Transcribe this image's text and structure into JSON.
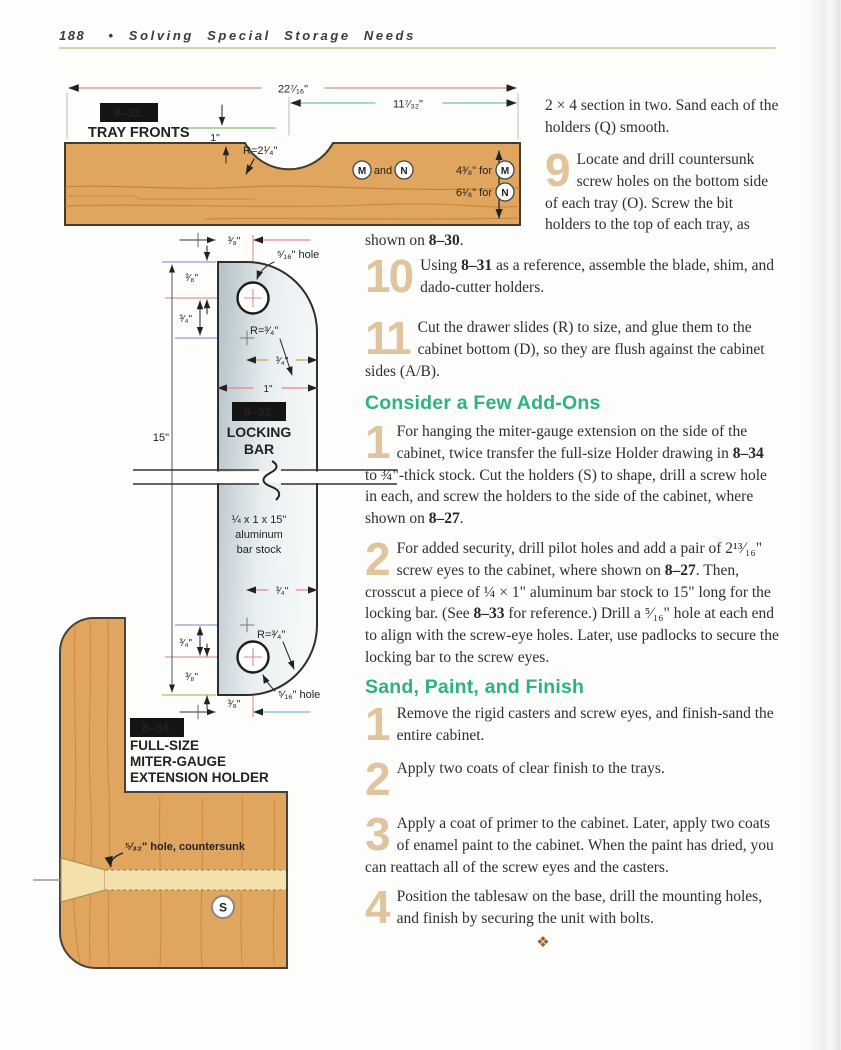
{
  "page": {
    "number": "188",
    "separator": "•",
    "title": "Solving Special Storage Needs"
  },
  "fig32": {
    "tag": "8–32.",
    "caption": "TRAY FRONTS",
    "dims": {
      "overall": "22⁷⁄₁₆\"",
      "offset": "11⁷⁄₃₂\"",
      "depth": "1\"",
      "radius": "R=2¹⁄₄\""
    },
    "labels": {
      "m": "M",
      "and": "and",
      "n": "N",
      "for_m": "4³⁄₈\" for",
      "for_n": "6¹⁄₈\" for"
    }
  },
  "fig33": {
    "tag": "8–33.",
    "caption_line1": "LOCKING",
    "caption_line2": "BAR",
    "dim_38": "³⁄₈\"",
    "dim_34": "³⁄₄\"",
    "dim_1": "1\"",
    "dim_15": "15\"",
    "radius": "R=³⁄₄\"",
    "hole": "⁵⁄₁₆\" hole",
    "stock_line1": "¼ x 1 x 15\"",
    "stock_line2": "aluminum",
    "stock_line3": "bar stock"
  },
  "fig34": {
    "tag": "8–34.",
    "caption_line1": "FULL-SIZE",
    "caption_line2": "MITER-GAUGE",
    "caption_line3": "EXTENSION HOLDER",
    "hole_note": "⁵⁄₃₂\" hole, countersunk",
    "letter_s": "S"
  },
  "article": {
    "intro_tail": "2 × 4 section in two. Sand each of the holders (Q) smooth.",
    "step9": {
      "num": "9",
      "segments": [
        {
          "t": "Locate and drill countersunk screw holes on the bottom side of each tray (O). Screw the bit holders to the top of each tray, as"
        }
      ]
    },
    "step9_tail": {
      "segments": [
        {
          "t": "shown on "
        },
        {
          "t": "8–30",
          "b": true
        },
        {
          "t": "."
        }
      ]
    },
    "step10": {
      "num": "10",
      "segments": [
        {
          "t": "Using "
        },
        {
          "t": "8–31",
          "b": true
        },
        {
          "t": " as a reference, assemble the blade, shim, and dado-cutter holders."
        }
      ]
    },
    "step11": {
      "num": "11",
      "segments": [
        {
          "t": "Cut the drawer slides (R) to size, and glue them to the cabinet bottom (D), so they are flush against the cabinet sides (A/B)."
        }
      ]
    },
    "addons_heading": "Consider a Few Add-Ons",
    "addons1": {
      "num": "1",
      "segments": [
        {
          "t": "For hanging the miter-gauge extension on the side of the cabinet, twice transfer the full-size Holder drawing in "
        },
        {
          "t": "8–34",
          "b": true
        },
        {
          "t": " to ¾\"-thick stock. Cut the holders (S) to shape, drill a screw hole in each, and screw the holders to the side of the cabinet, where shown on "
        },
        {
          "t": "8–27",
          "b": true
        },
        {
          "t": "."
        }
      ]
    },
    "addons2": {
      "num": "2",
      "segments": [
        {
          "t": "For added security, drill pilot holes and add a pair of 2¹³⁄₁₆\" screw eyes to the cabinet, where shown on "
        },
        {
          "t": "8–27",
          "b": true
        },
        {
          "t": ". Then, crosscut a piece of ¼ × 1\" aluminum bar stock to 15\" long for the locking bar. (See "
        },
        {
          "t": "8–33",
          "b": true
        },
        {
          "t": " for reference.) Drill a ⁵⁄₁₆\" hole at each end to align with the screw-eye holes. Later, use padlocks to secure the locking bar to the screw eyes."
        }
      ]
    },
    "finish_heading": "Sand, Paint, and Finish",
    "finish1": {
      "num": "1",
      "segments": [
        {
          "t": "Remove the rigid casters and screw eyes, and finish-sand the entire cabinet."
        }
      ]
    },
    "finish2": {
      "num": "2",
      "segments": [
        {
          "t": "Apply two coats of clear finish to the trays."
        }
      ]
    },
    "finish3": {
      "num": "3",
      "segments": [
        {
          "t": "Apply a coat of primer to the cabinet. Later, apply two coats of enamel paint to the cabinet. When the paint has dried, you can reattach all of the screw eyes and the casters."
        }
      ]
    },
    "finish4": {
      "num": "4",
      "segments": [
        {
          "t": "Position the tablesaw on the base, drill the mounting holes, and finish by securing the unit with bolts."
        }
      ]
    },
    "ornament": "❖"
  },
  "colors": {
    "wood": "#e0a65f",
    "green_heading": "#2eb183",
    "step_numeral": "#e0c49e",
    "label_box": "#141414",
    "rule": "#d9d2a4"
  }
}
